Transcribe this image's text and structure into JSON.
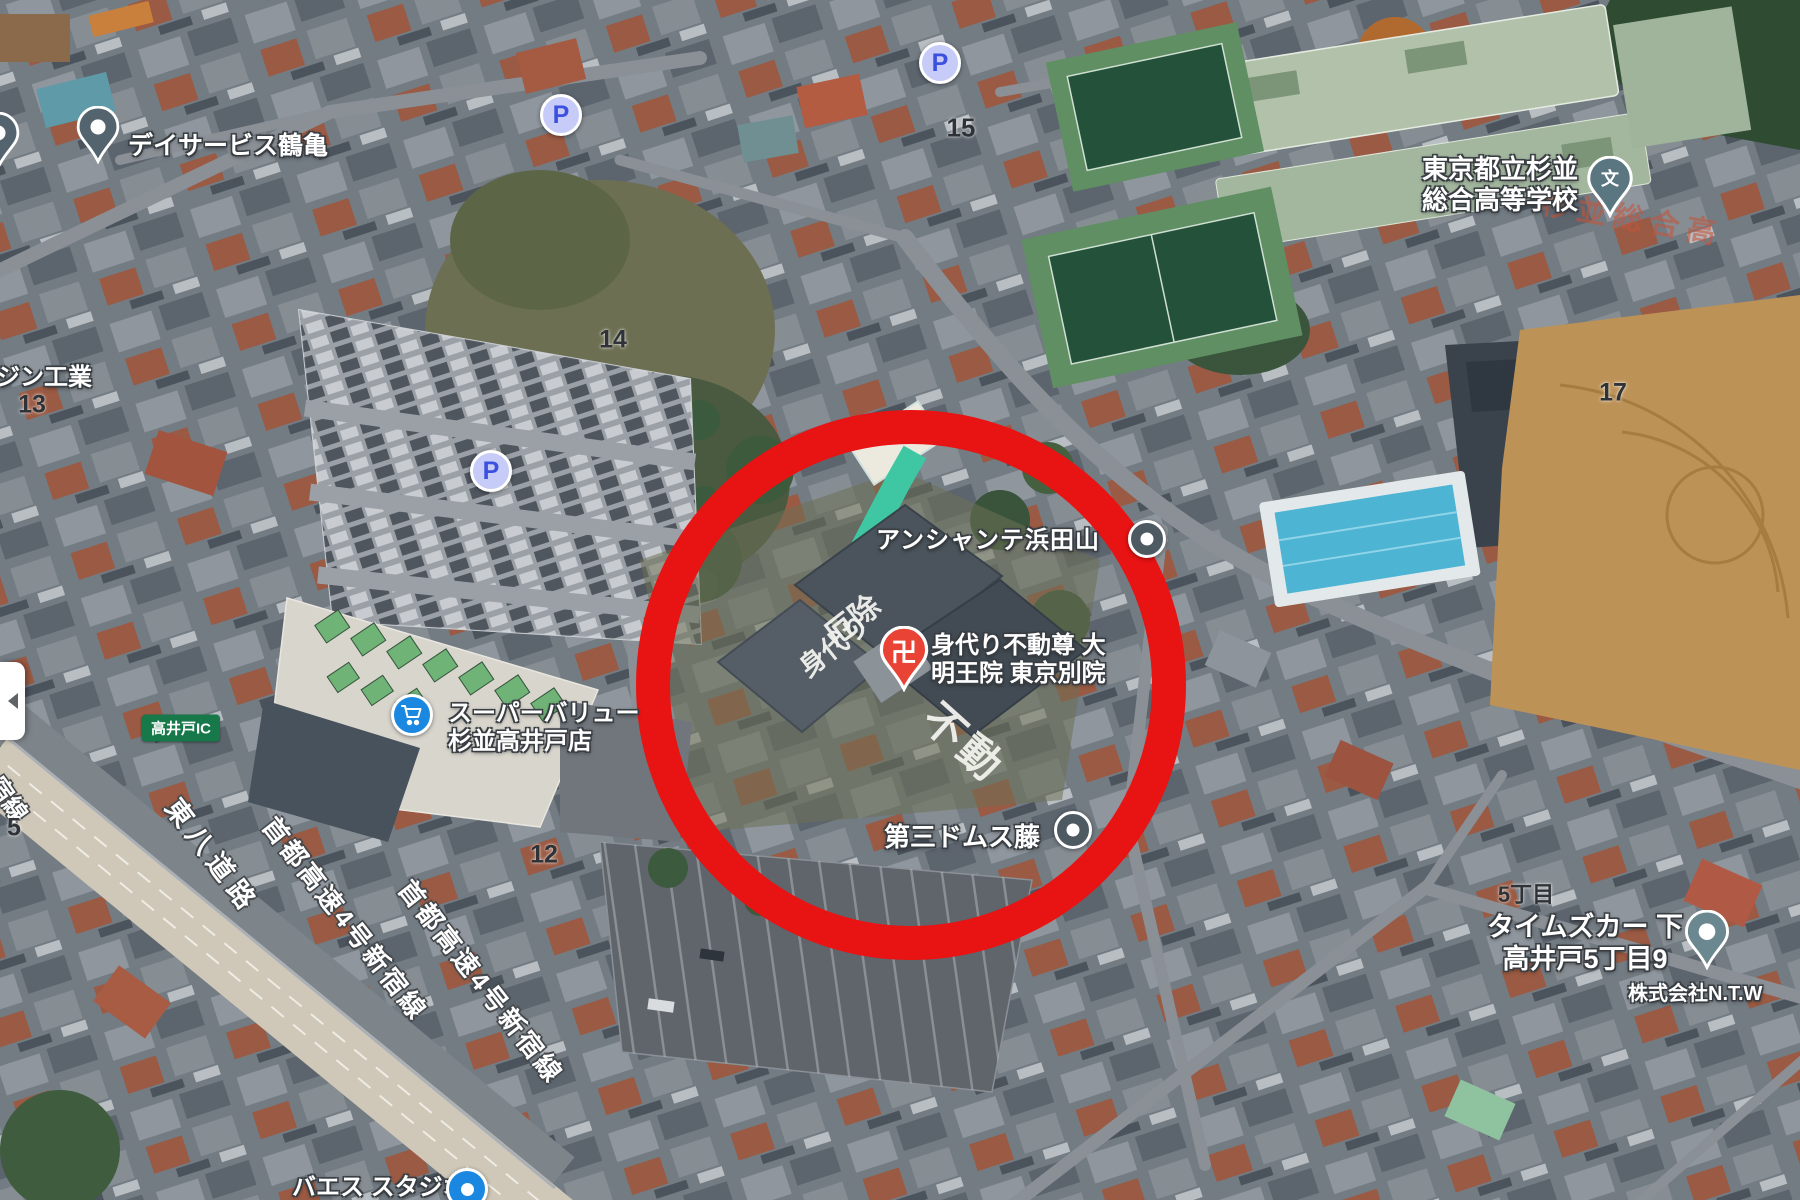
{
  "markers": {
    "daycare": {
      "label": "デイサービス鶴亀"
    },
    "school": {
      "line1": "東京都立杉並",
      "line2": "総合高等学校",
      "icon_glyph": "文"
    },
    "anchante": {
      "label": "アンシャンテ浜田山"
    },
    "temple": {
      "line1": "身代り不動尊 大",
      "line2": "明王院 東京別院",
      "icon_glyph": "卍"
    },
    "domus": {
      "label": "第三ドムス藤"
    },
    "supermarket": {
      "line1": "スーパーバリュー",
      "line2": "杉並高井戸店"
    },
    "timescar": {
      "line1": "タイムズカー 下",
      "line2": "高井戸5丁目9"
    },
    "ntw": {
      "label": "株式会社N.T.W"
    },
    "studio": {
      "label": "バエス スタジオ"
    },
    "engineering": {
      "label": "ジン工業"
    }
  },
  "roads": {
    "tohachi": "東八道路",
    "shuto": "首都高速4号新宿線",
    "shukusen": "宿線",
    "takaido_ic": "高井戸IC"
  },
  "blocks": {
    "b13": "13",
    "b14": "14",
    "b15": "15",
    "b12": "12",
    "b17": "17",
    "b5": "5",
    "chome5": "5丁目"
  },
  "parking_glyph": "P",
  "rooftop": {
    "yakuyoke": "厄除",
    "migawari": "身代り",
    "fudo": "不動",
    "school_roof": "杉並総合高"
  },
  "colors": {
    "annotation_red": "#e81313",
    "pin_gray": "#54646e",
    "pin_school": "#5a7680",
    "pin_temple_red": "#e94335",
    "parking_fill": "#c6cbf8",
    "parking_letter": "#3c50e0",
    "poi_blue": "#1a88e0",
    "ic_green": "#17784a"
  }
}
